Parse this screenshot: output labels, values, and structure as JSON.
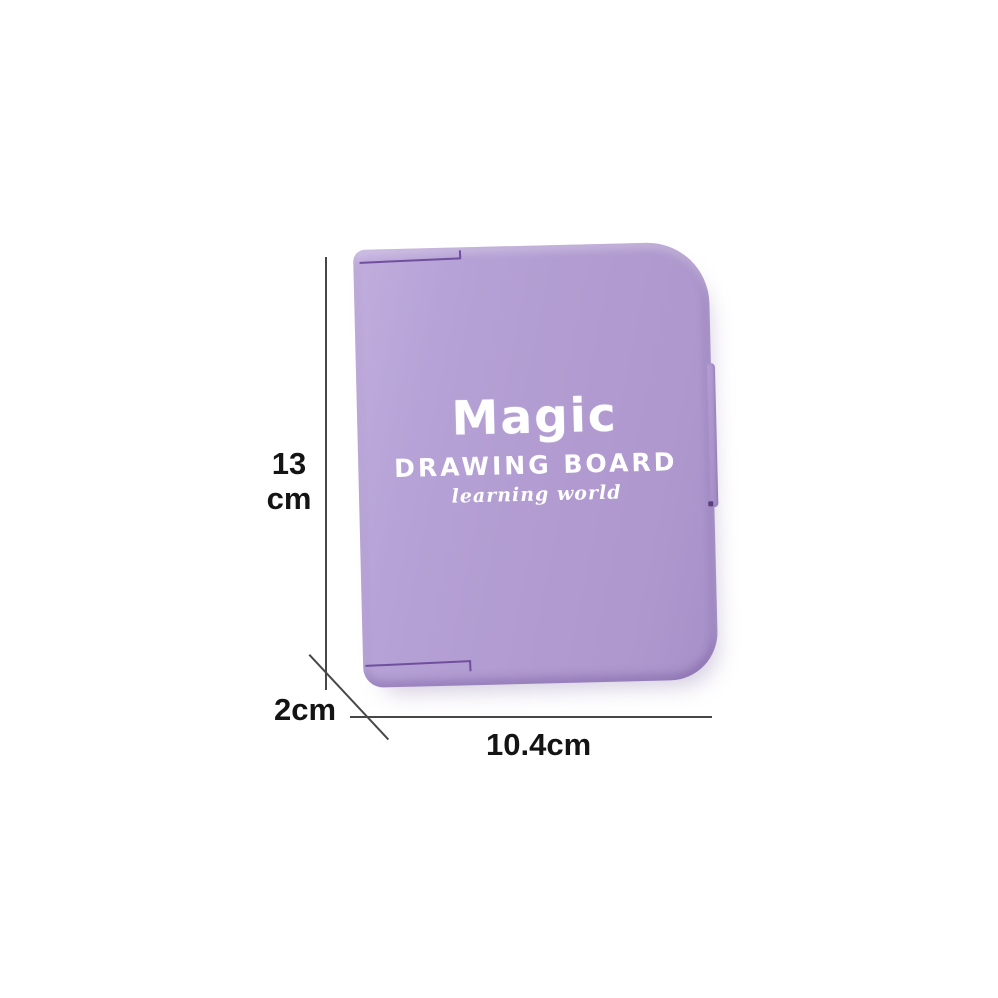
{
  "scene": {
    "background_color": "#ffffff"
  },
  "board": {
    "title": "Magic",
    "subtitle": "DRAWING BOARD",
    "tagline": "learning world",
    "body_color": "#b19bd0",
    "highlight_color": "#c1aedd",
    "seam_color": "#6f4f9e",
    "print_color": "#ffffff"
  },
  "dimensions": {
    "line_color": "#474747",
    "label_color": "#141414",
    "height": {
      "value": "13",
      "unit": "cm"
    },
    "depth": {
      "label": "2cm"
    },
    "width": {
      "label": "10.4cm"
    }
  }
}
